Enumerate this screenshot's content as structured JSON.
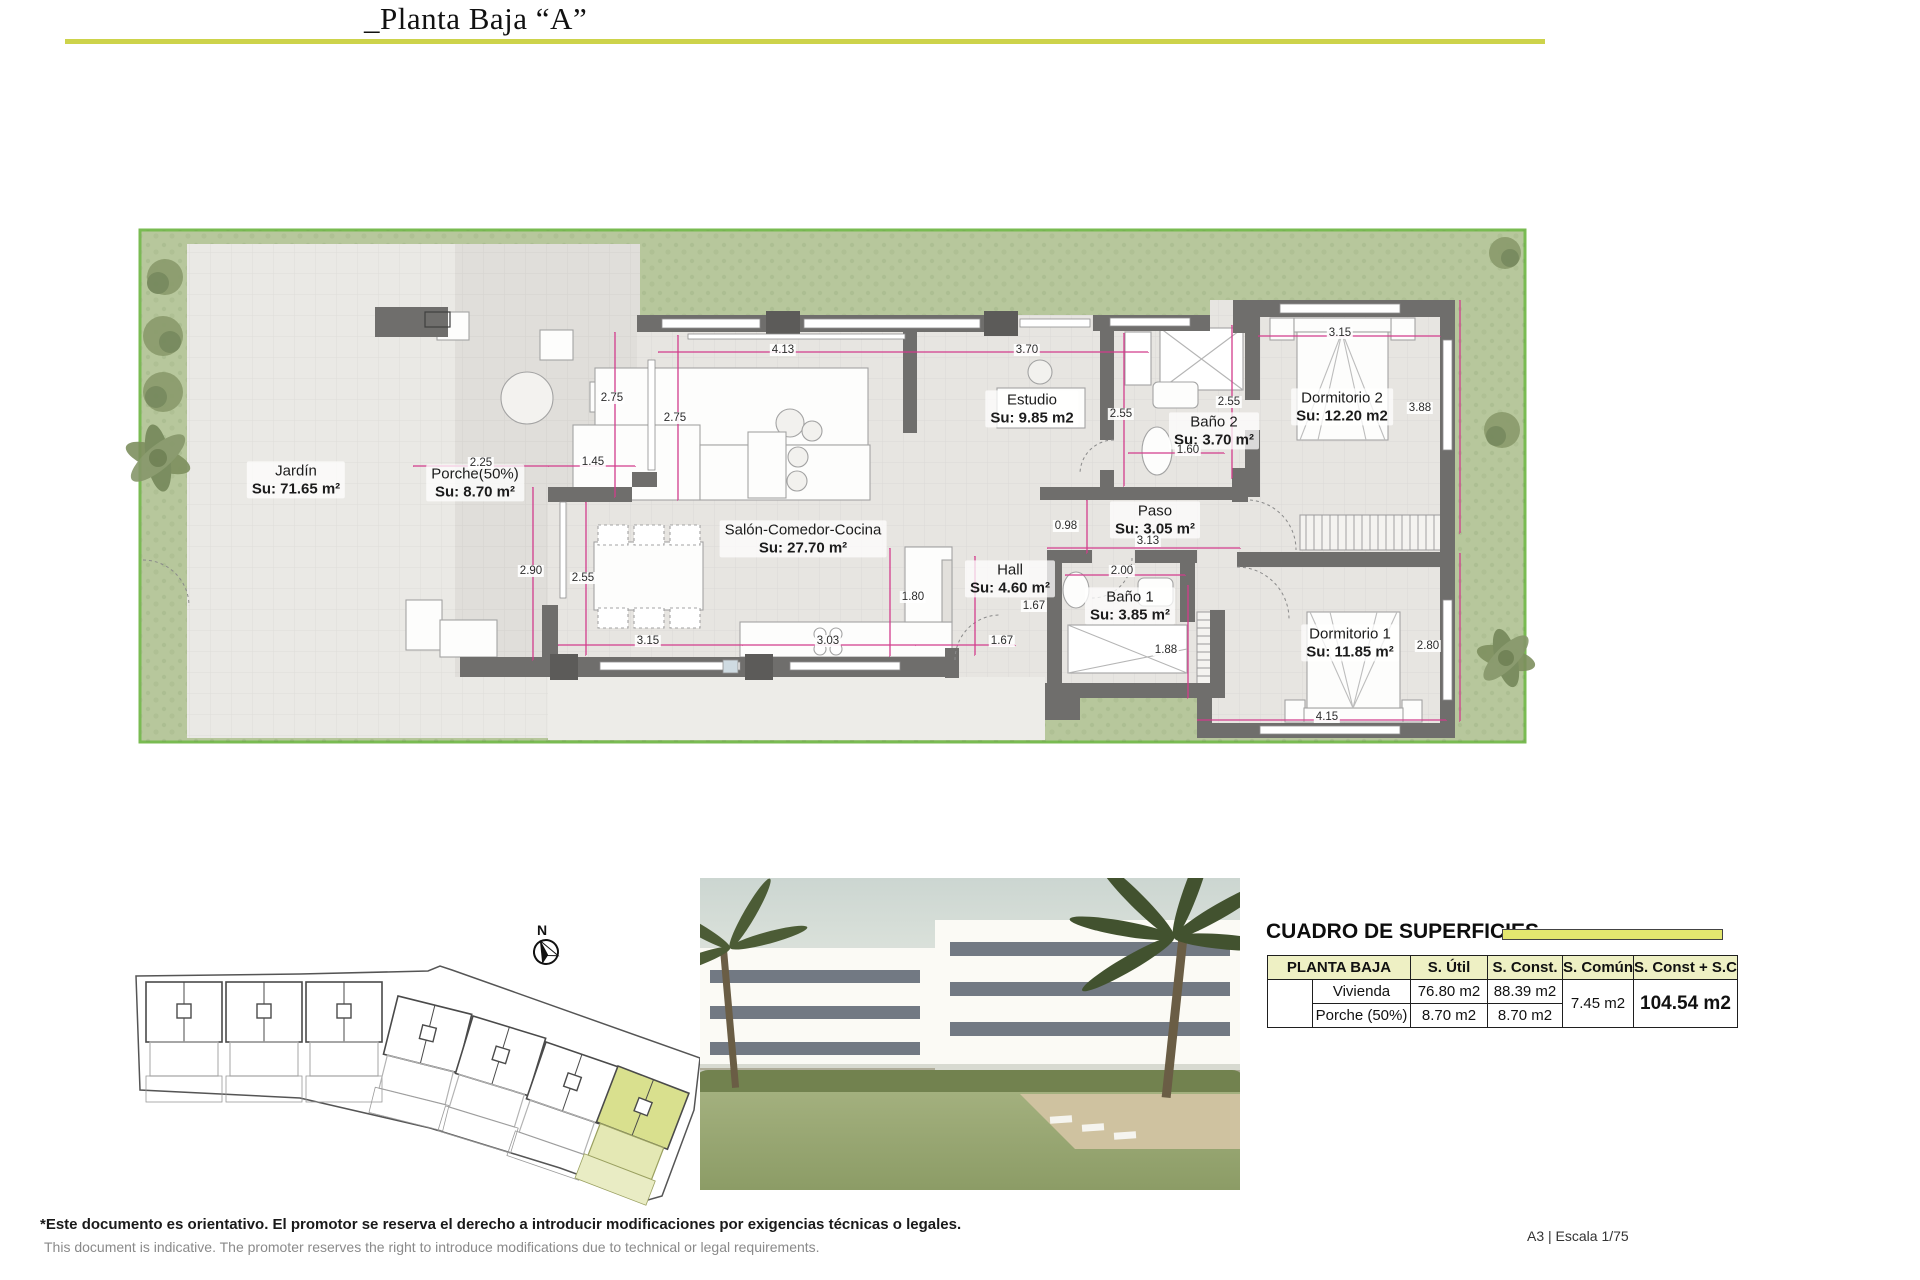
{
  "title": "_Planta Baja “A”",
  "plan": {
    "north_label": "N",
    "rooms": [
      {
        "id": "jardin",
        "name": "Jardín",
        "area": "Su: 71.65 m²",
        "x": 296,
        "y": 480
      },
      {
        "id": "porche",
        "name": "Porche(50%)",
        "area": "Su: 8.70 m²",
        "x": 475,
        "y": 483
      },
      {
        "id": "salon",
        "name": "Salón-Comedor-Cocina",
        "area": "Su: 27.70 m²",
        "x": 803,
        "y": 539
      },
      {
        "id": "estudio",
        "name": "Estudio",
        "area": "Su: 9.85 m2",
        "x": 1032,
        "y": 409
      },
      {
        "id": "bano2",
        "name": "Baño 2",
        "area": "Su: 3.70 m²",
        "x": 1214,
        "y": 431
      },
      {
        "id": "dorm2",
        "name": "Dormitorio 2",
        "area": "Su: 12.20 m2",
        "x": 1342,
        "y": 407
      },
      {
        "id": "paso",
        "name": "Paso",
        "area": "Su: 3.05 m²",
        "x": 1155,
        "y": 520
      },
      {
        "id": "hall",
        "name": "Hall",
        "area": "Su: 4.60 m²",
        "x": 1010,
        "y": 579
      },
      {
        "id": "bano1",
        "name": "Baño 1",
        "area": "Su: 3.85 m²",
        "x": 1130,
        "y": 606
      },
      {
        "id": "dorm1",
        "name": "Dormitorio 1",
        "area": "Su: 11.85 m²",
        "x": 1350,
        "y": 643
      }
    ],
    "dims": [
      {
        "t": "4.13",
        "x": 783,
        "y": 350
      },
      {
        "t": "3.70",
        "x": 1027,
        "y": 350
      },
      {
        "t": "3.15",
        "x": 1340,
        "y": 333
      },
      {
        "t": "2.75",
        "x": 612,
        "y": 398
      },
      {
        "t": "2.75",
        "x": 675,
        "y": 418
      },
      {
        "t": "2.55",
        "x": 1121,
        "y": 414
      },
      {
        "t": "2.55",
        "x": 1229,
        "y": 402
      },
      {
        "t": "2.25",
        "x": 481,
        "y": 463
      },
      {
        "t": "1.45",
        "x": 593,
        "y": 462
      },
      {
        "t": "2.90",
        "x": 531,
        "y": 571
      },
      {
        "t": "2.55",
        "x": 583,
        "y": 578
      },
      {
        "t": "1.60",
        "x": 1188,
        "y": 450
      },
      {
        "t": "0.98",
        "x": 1066,
        "y": 526
      },
      {
        "t": "3.13",
        "x": 1148,
        "y": 541
      },
      {
        "t": "2.00",
        "x": 1122,
        "y": 571
      },
      {
        "t": "1.80",
        "x": 913,
        "y": 597
      },
      {
        "t": "1.67",
        "x": 1034,
        "y": 606
      },
      {
        "t": "1.67",
        "x": 1002,
        "y": 641
      },
      {
        "t": "3.15",
        "x": 648,
        "y": 641
      },
      {
        "t": "3.03",
        "x": 828,
        "y": 641
      },
      {
        "t": "1.88",
        "x": 1166,
        "y": 650
      },
      {
        "t": "4.15",
        "x": 1327,
        "y": 717
      },
      {
        "t": "3.88",
        "x": 1420,
        "y": 408
      },
      {
        "t": "2.80",
        "x": 1428,
        "y": 646
      }
    ]
  },
  "surfaces": {
    "title": "CUADRO DE SUPERFICIES",
    "columns": [
      "PLANTA BAJA",
      "S. Útil",
      "S. Const.",
      "S. Común",
      "S. Const + S.C"
    ],
    "rows": [
      {
        "label": "Vivienda",
        "util": "76.80 m2",
        "sconst": "88.39 m2"
      },
      {
        "label": "Porche (50%)",
        "util": "8.70 m2",
        "sconst": "8.70 m2"
      }
    ],
    "comun": "7.45 m2",
    "total": "104.54 m2"
  },
  "footer": {
    "line1": "*Este documento es orientativo. El promotor se reserva el derecho a introducir modificaciones por exigencias técnicas o legales.",
    "line2": "This document is indicative. The promoter reserves the right to introduce modifications due to technical or legal requirements.",
    "scale": "A3 | Escala 1/75"
  },
  "colors": {
    "accent": "#cdd34b",
    "table_header": "#eef0c4",
    "dimension_line": "#d23c8c",
    "grass": "#b7c79c",
    "highlight_unit": "#dfe3a8"
  }
}
